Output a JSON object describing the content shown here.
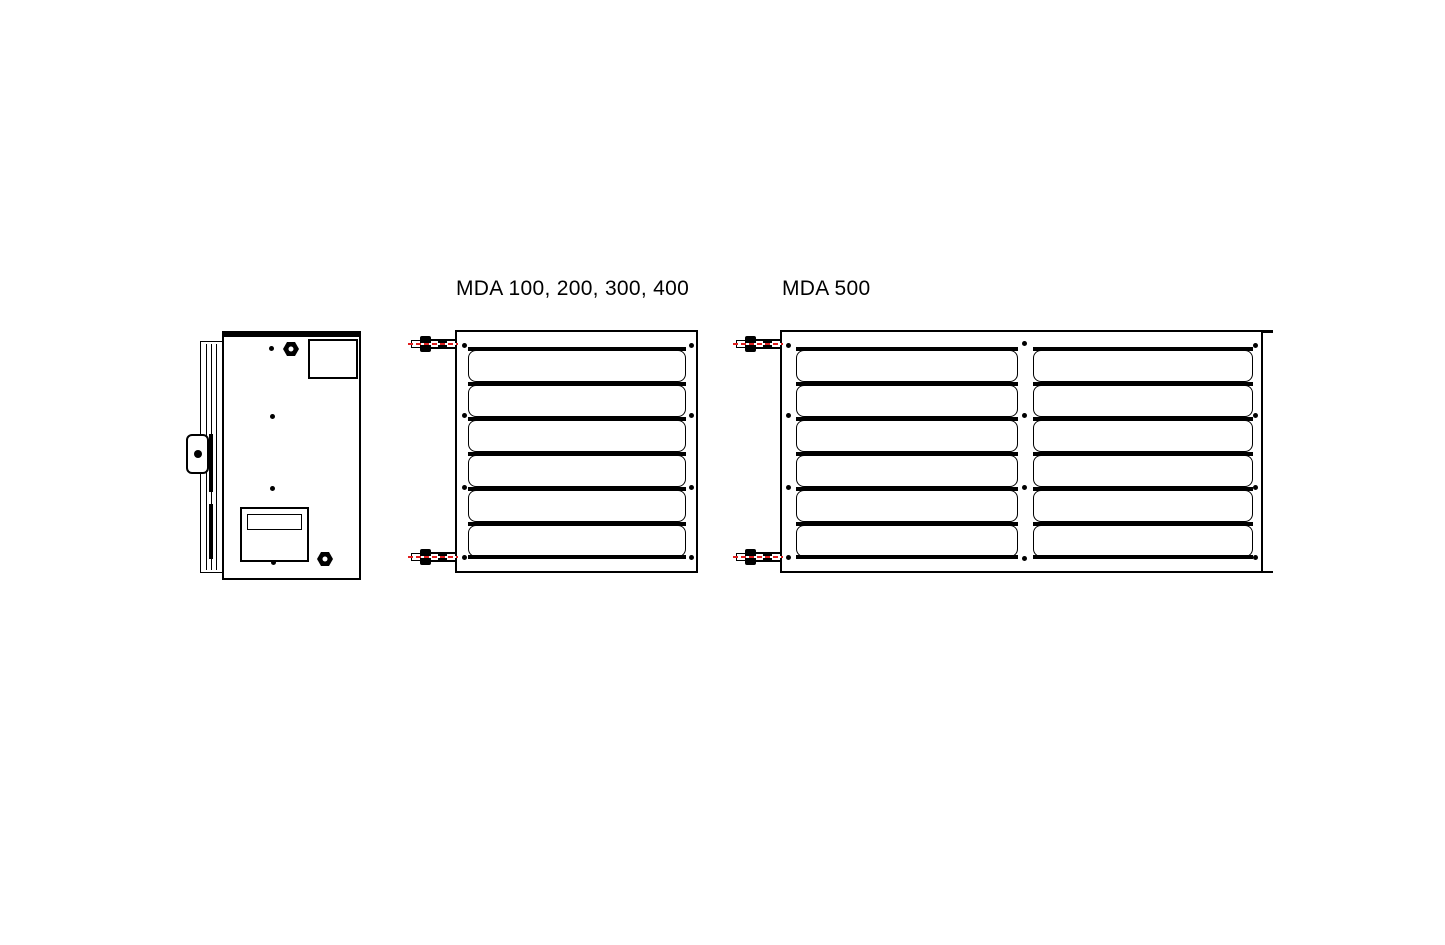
{
  "canvas": {
    "background": "#ffffff",
    "line_color": "#000000",
    "pipe_centerline_color": "#e01f1f"
  },
  "drawings": {
    "side_view": {
      "description": "unit side view with mounting bracket, hex nuts and rating plate"
    },
    "mda_small": {
      "title": "MDA 100, 200, 300, 400",
      "louver_slats": 6,
      "screws_per_side": 4,
      "pipe_connections": 2
    },
    "mda_500": {
      "title": "MDA 500",
      "sections": 2,
      "louver_slats": 6,
      "screw_columns": 3,
      "pipe_connections": 2
    }
  }
}
